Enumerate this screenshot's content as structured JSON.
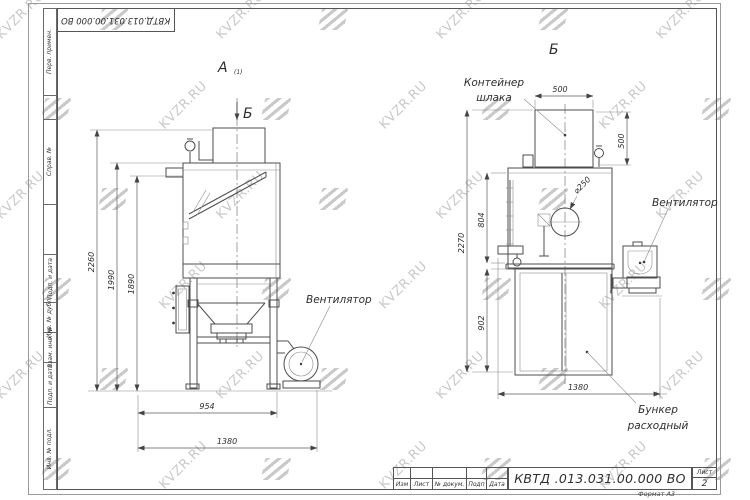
{
  "watermark": {
    "text": "KVZR.RU"
  },
  "sheet": {
    "stamp_top": "КВТД.013.031.00.000  ВО",
    "side_labels": [
      "Перв. примен.",
      "Справ. №",
      "Подп. и дата",
      "Инв. № дубл.",
      "Взам. инв. №",
      "Подп. и дата",
      "Инв. № подл."
    ],
    "format_note": "Формат А3"
  },
  "title_block": {
    "doc_number": "КВТД .013.031.00.000  ВО",
    "columns": [
      "Изм",
      "Лист",
      "№ докум.",
      "Подп",
      "Дата"
    ],
    "sheet_word": "Лист",
    "sheet_number": "2"
  },
  "view_a": {
    "label": "А",
    "label_note": "(1)",
    "cut_mark": "Б",
    "fan_label": "Вентилятор",
    "dim_2260": "2260",
    "dim_1990": "1990",
    "dim_1890": "1890",
    "dim_954": "954",
    "dim_1380": "1380"
  },
  "view_b": {
    "label": "Б",
    "slag_container_line1": "Контейнер",
    "slag_container_line2": "шлака",
    "fan_label": "Вентилятор",
    "bunker_line1": "Бункер",
    "bunker_line2": "расходный",
    "dim_500w": "500",
    "dim_500h": "500",
    "dim_2270": "2270",
    "dim_804": "804",
    "dim_902": "902",
    "dim_1380": "1380",
    "dim_d250": "⌀250"
  }
}
